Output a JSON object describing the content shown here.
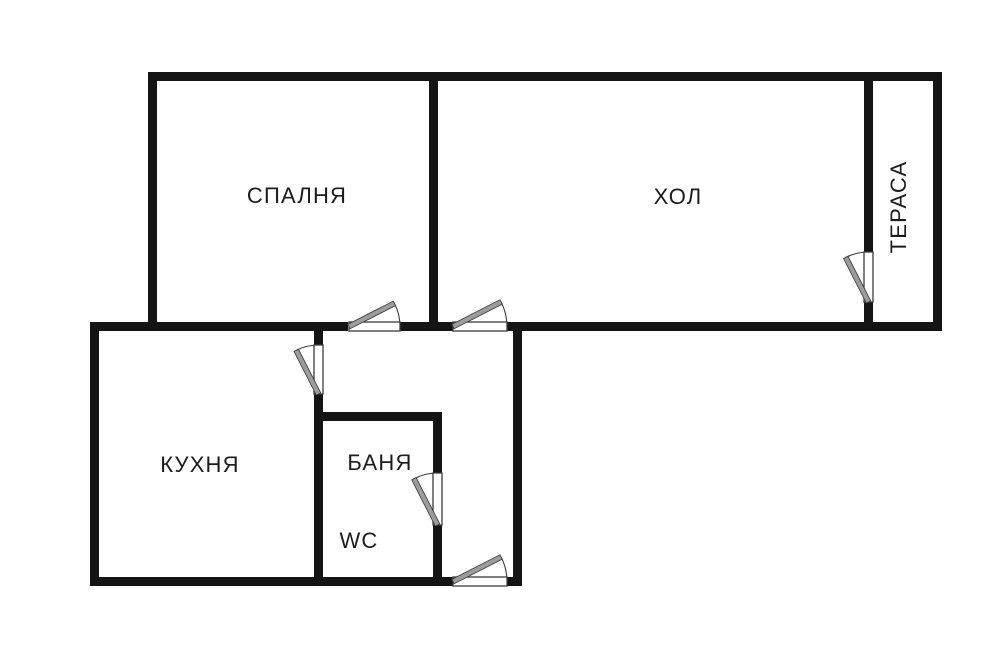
{
  "plan": {
    "rooms": {
      "bedroom": {
        "label": "СПАЛНЯ"
      },
      "hall": {
        "label": "ХОЛ"
      },
      "terrace": {
        "label": "ТЕРАСА"
      },
      "kitchen": {
        "label": "КУХНЯ"
      },
      "bathroom": {
        "label": "БАНЯ"
      },
      "wc": {
        "label": "WC"
      }
    },
    "doors": [
      "bedroom-door",
      "hall-door",
      "terrace-door",
      "kitchen-door",
      "bathroom-door",
      "entry-door"
    ],
    "colors": {
      "background": "#ffffff",
      "wall": "#141414",
      "door_outline": "#3c3c3c",
      "door_leaf": "#9c9c9c",
      "label_text": "#1c1c1c"
    }
  }
}
